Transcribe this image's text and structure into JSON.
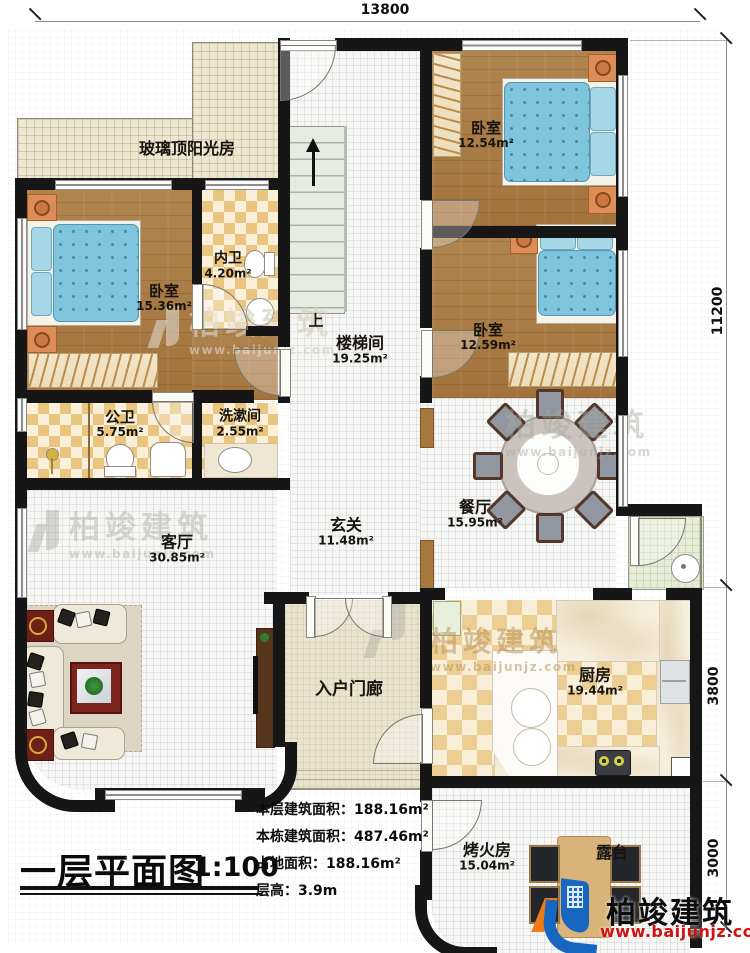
{
  "dimensions": {
    "top": "13800",
    "right_total": "11200",
    "right_kitchen": "3800",
    "right_fire": "3000"
  },
  "rooms": {
    "sunroom": {
      "name": "玻璃顶阳光房"
    },
    "bedroom_left": {
      "name": "卧室",
      "area": "15.36m²"
    },
    "inner_bath": {
      "name": "内卫",
      "area": "4.20m²"
    },
    "stair_hall": {
      "name": "楼梯间",
      "area": "19.25m²",
      "up": "上"
    },
    "bedroom_top": {
      "name": "卧室",
      "area": "12.54m²"
    },
    "bedroom_right": {
      "name": "卧室",
      "area": "12.59m²"
    },
    "public_bath": {
      "name": "公卫",
      "area": "5.75m²"
    },
    "washroom": {
      "name": "洗漱间",
      "area": "2.55m²"
    },
    "foyer": {
      "name": "玄关",
      "area": "11.48m²"
    },
    "dining": {
      "name": "餐厅",
      "area": "15.95m²"
    },
    "living": {
      "name": "客厅",
      "area": "30.85m²"
    },
    "porch": {
      "name": "入户门廊"
    },
    "kitchen": {
      "name": "厨房",
      "area": "19.44m²"
    },
    "fire_room": {
      "name": "烤火房",
      "area": "15.04m²"
    },
    "terrace": {
      "name": "露台"
    }
  },
  "title": {
    "name": "一层平面图",
    "scale": "1:100"
  },
  "info": {
    "lines": [
      {
        "label": "本层建筑面积：",
        "value": "188.16m²"
      },
      {
        "label": "本栋建筑面积：",
        "value": "487.46m²"
      },
      {
        "label": "占地面积：",
        "value": "188.16m²"
      },
      {
        "label": "层高：",
        "value": "3.9m"
      }
    ]
  },
  "watermark": {
    "brand": "柏竣建筑",
    "url": "www.baijunjz.com"
  },
  "logo": {
    "brand": "柏竣建筑",
    "url": "www.baijunjz.com"
  },
  "colors": {
    "brand_blue": "#1767c1",
    "brand_orange": "#ee7b17",
    "url_red": "#cf1212",
    "wall": "#161616"
  }
}
